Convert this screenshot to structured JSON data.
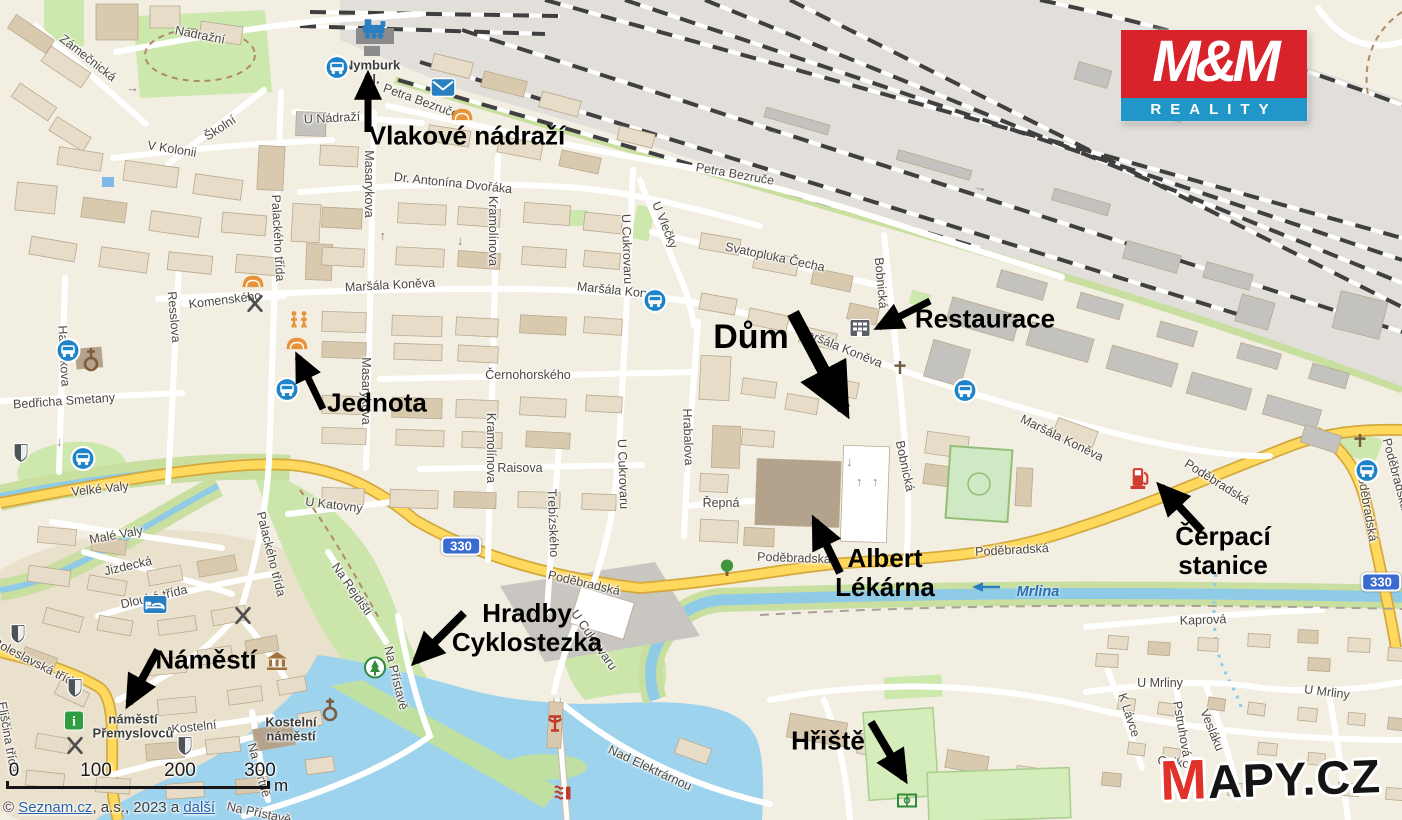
{
  "colors": {
    "road_yellow": "#ffd95e",
    "water_blue": "#9ed3ee",
    "brand_red": "#d8232a",
    "brand_blue": "#2196c9",
    "annotation": "#000000"
  },
  "branding": {
    "mm_logo": {
      "top": "M&M",
      "bottom": "REALITY"
    },
    "mapy_logo": {
      "m": "M",
      "rest": "APY.CZ"
    }
  },
  "attribution": {
    "p1": "© ",
    "link1": "Seznam.cz",
    "p2": ", a.s., 2023 a ",
    "link2": "další"
  },
  "scale_bar": {
    "ticks": [
      "0",
      "100",
      "200",
      "300"
    ],
    "unit": "m"
  },
  "route_badges": [
    {
      "text": "330",
      "x": 461,
      "y": 546
    },
    {
      "text": "330",
      "x": 1381,
      "y": 582
    }
  ],
  "annotations": [
    {
      "id": "vlakove-nadrazi",
      "lines": [
        "Vlakové nádraží"
      ],
      "x": 467,
      "y": 136,
      "size": 26,
      "arrow": {
        "x1": 368,
        "y1": 132,
        "x2": 368,
        "y2": 76,
        "w": 7
      }
    },
    {
      "id": "jednota",
      "lines": [
        "Jednota"
      ],
      "x": 377,
      "y": 403,
      "size": 26,
      "arrow": {
        "x1": 323,
        "y1": 409,
        "x2": 298,
        "y2": 357,
        "w": 7
      }
    },
    {
      "id": "dum",
      "lines": [
        "Dům"
      ],
      "x": 751,
      "y": 337,
      "size": 34,
      "arrow": {
        "x1": 793,
        "y1": 313,
        "x2": 844,
        "y2": 409,
        "w": 13
      }
    },
    {
      "id": "restaurace",
      "lines": [
        "Restaurace"
      ],
      "x": 985,
      "y": 319,
      "size": 26,
      "arrow": {
        "x1": 930,
        "y1": 301,
        "x2": 879,
        "y2": 327,
        "w": 7
      }
    },
    {
      "id": "albert-lekarna",
      "lines": [
        "Albert",
        "Lékárna"
      ],
      "x": 885,
      "y": 573,
      "size": 26,
      "arrow": {
        "x1": 840,
        "y1": 573,
        "x2": 815,
        "y2": 521,
        "w": 8
      }
    },
    {
      "id": "cerpaci-stanice",
      "lines": [
        "Čerpací",
        "stanice"
      ],
      "x": 1223,
      "y": 551,
      "size": 26,
      "arrow": {
        "x1": 1202,
        "y1": 531,
        "x2": 1161,
        "y2": 487,
        "w": 8
      }
    },
    {
      "id": "hradby-cyklostezka",
      "lines": [
        "Hradby",
        "Cyklostezka"
      ],
      "x": 527,
      "y": 628,
      "size": 26,
      "arrow": {
        "x1": 464,
        "y1": 613,
        "x2": 416,
        "y2": 661,
        "w": 8
      }
    },
    {
      "id": "namesti",
      "lines": [
        "Náměstí"
      ],
      "x": 206,
      "y": 660,
      "size": 26,
      "arrow": {
        "x1": 158,
        "y1": 650,
        "x2": 129,
        "y2": 703,
        "w": 8
      }
    },
    {
      "id": "hriste",
      "lines": [
        "Hřiště"
      ],
      "x": 828,
      "y": 741,
      "size": 26,
      "arrow": {
        "x1": 871,
        "y1": 722,
        "x2": 904,
        "y2": 778,
        "w": 8
      }
    }
  ],
  "area_labels": [
    {
      "lines": [
        "Nymburk",
        "hl."
      ],
      "x": 372,
      "y": 73
    },
    {
      "lines": [
        "náměstí",
        "Přemyslovců"
      ],
      "x": 133,
      "y": 727
    },
    {
      "lines": [
        "Kostelní",
        "náměstí"
      ],
      "x": 291,
      "y": 730
    }
  ],
  "water_labels": [
    {
      "text": "Mrlina",
      "x": 1038,
      "y": 592
    }
  ],
  "street_labels": [
    {
      "text": "Nádražní",
      "x": 200,
      "y": 35,
      "rot": 11
    },
    {
      "text": "Zámečnická",
      "x": 88,
      "y": 58,
      "rot": 38
    },
    {
      "text": "Školní",
      "x": 220,
      "y": 128,
      "rot": -33
    },
    {
      "text": "V Kolonii",
      "x": 172,
      "y": 149,
      "rot": 9
    },
    {
      "text": "U Nádraží",
      "x": 332,
      "y": 118,
      "rot": -3
    },
    {
      "text": "Petra Bezruče",
      "x": 421,
      "y": 101,
      "rot": 20
    },
    {
      "text": "Petra Bezruče",
      "x": 735,
      "y": 174,
      "rot": 10
    },
    {
      "text": "Dr. Antonína Dvořáka",
      "x": 453,
      "y": 183,
      "rot": 6
    },
    {
      "text": "Masarykova",
      "x": 369,
      "y": 184,
      "rot": 90
    },
    {
      "text": "Masarykova",
      "x": 366,
      "y": 391,
      "rot": 90
    },
    {
      "text": "Kramolínova",
      "x": 493,
      "y": 231,
      "rot": 90
    },
    {
      "text": "Kramolínova",
      "x": 491,
      "y": 448,
      "rot": 90
    },
    {
      "text": "U Cukrovaru",
      "x": 627,
      "y": 249,
      "rot": 88
    },
    {
      "text": "U Cukrovaru",
      "x": 623,
      "y": 474,
      "rot": 88
    },
    {
      "text": "U Cukrovaru",
      "x": 594,
      "y": 640,
      "rot": 55
    },
    {
      "text": "U Vlečky",
      "x": 665,
      "y": 225,
      "rot": 68
    },
    {
      "text": "Maršála Koněva",
      "x": 390,
      "y": 285,
      "rot": -3
    },
    {
      "text": "Maršála Koněva",
      "x": 622,
      "y": 291,
      "rot": 6
    },
    {
      "text": "Maršála Koněva",
      "x": 840,
      "y": 347,
      "rot": 22
    },
    {
      "text": "Maršála Koněva",
      "x": 1062,
      "y": 438,
      "rot": 26
    },
    {
      "text": "Svatopluka Čecha",
      "x": 775,
      "y": 257,
      "rot": 12
    },
    {
      "text": "Bobnická",
      "x": 881,
      "y": 283,
      "rot": 85
    },
    {
      "text": "Bobnická",
      "x": 905,
      "y": 466,
      "rot": 78
    },
    {
      "text": "Černohorského",
      "x": 528,
      "y": 375,
      "rot": 0
    },
    {
      "text": "Raisova",
      "x": 520,
      "y": 468,
      "rot": 0
    },
    {
      "text": "Trebízského",
      "x": 553,
      "y": 523,
      "rot": 88
    },
    {
      "text": "Hrabalova",
      "x": 688,
      "y": 437,
      "rot": 88
    },
    {
      "text": "Řepná",
      "x": 721,
      "y": 503,
      "rot": 0
    },
    {
      "text": "Poděbradská",
      "x": 584,
      "y": 583,
      "rot": 13
    },
    {
      "text": "Poděbradská",
      "x": 794,
      "y": 558,
      "rot": 2
    },
    {
      "text": "Poděbradská",
      "x": 1012,
      "y": 550,
      "rot": -3
    },
    {
      "text": "Poděbradská",
      "x": 1217,
      "y": 482,
      "rot": 32
    },
    {
      "text": "Poděbradská",
      "x": 1367,
      "y": 505,
      "rot": 80
    },
    {
      "text": "Poděbradská",
      "x": 1396,
      "y": 474,
      "rot": 75
    },
    {
      "text": "Velké Valy",
      "x": 100,
      "y": 489,
      "rot": -6
    },
    {
      "text": "Malé Valy",
      "x": 116,
      "y": 535,
      "rot": -10
    },
    {
      "text": "Jizdecká",
      "x": 128,
      "y": 566,
      "rot": -13
    },
    {
      "text": "Dlouhá třída",
      "x": 154,
      "y": 597,
      "rot": -13
    },
    {
      "text": "Palackého třída",
      "x": 278,
      "y": 238,
      "rot": 87
    },
    {
      "text": "Palackého třída",
      "x": 271,
      "y": 554,
      "rot": 76
    },
    {
      "text": "Resslova",
      "x": 174,
      "y": 317,
      "rot": 85
    },
    {
      "text": "Komenského",
      "x": 225,
      "y": 300,
      "rot": -7
    },
    {
      "text": "Havlíčkova",
      "x": 64,
      "y": 356,
      "rot": 87
    },
    {
      "text": "Bedřicha Smetany",
      "x": 64,
      "y": 401,
      "rot": -4
    },
    {
      "text": "Eliščina třída",
      "x": 8,
      "y": 737,
      "rot": 80
    },
    {
      "text": "Boleslavská třída",
      "x": 36,
      "y": 663,
      "rot": 27
    },
    {
      "text": "Kostelní",
      "x": 194,
      "y": 727,
      "rot": -6
    },
    {
      "text": "Na Fortně",
      "x": 259,
      "y": 770,
      "rot": 74
    },
    {
      "text": "Na Rejdišti",
      "x": 352,
      "y": 589,
      "rot": 55
    },
    {
      "text": "Na Přístavě",
      "x": 396,
      "y": 678,
      "rot": 76
    },
    {
      "text": "Na Přístavě",
      "x": 259,
      "y": 813,
      "rot": 12
    },
    {
      "text": "U Katovny",
      "x": 334,
      "y": 505,
      "rot": 7
    },
    {
      "text": "Kaprová",
      "x": 1203,
      "y": 620,
      "rot": -2
    },
    {
      "text": "U Mrliny",
      "x": 1160,
      "y": 683,
      "rot": 0
    },
    {
      "text": "U Mrliny",
      "x": 1327,
      "y": 692,
      "rot": 7
    },
    {
      "text": "K Lávce",
      "x": 1129,
      "y": 715,
      "rot": 72
    },
    {
      "text": "Pstruhová",
      "x": 1182,
      "y": 729,
      "rot": 80
    },
    {
      "text": "Vesláku",
      "x": 1212,
      "y": 730,
      "rot": 68
    },
    {
      "text": "Osiková",
      "x": 1180,
      "y": 763,
      "rot": 7
    },
    {
      "text": "Nad Elektrárnou",
      "x": 650,
      "y": 768,
      "rot": 25
    }
  ],
  "pois": [
    {
      "icon": "train",
      "x": 375,
      "y": 32
    },
    {
      "icon": "bus",
      "x": 337,
      "y": 70
    },
    {
      "icon": "post",
      "x": 443,
      "y": 90
    },
    {
      "icon": "shop",
      "x": 462,
      "y": 116
    },
    {
      "icon": "shop",
      "x": 297,
      "y": 345
    },
    {
      "icon": "shop",
      "x": 253,
      "y": 283
    },
    {
      "icon": "playground",
      "x": 299,
      "y": 322
    },
    {
      "icon": "bus",
      "x": 287,
      "y": 392
    },
    {
      "icon": "bus",
      "x": 68,
      "y": 353
    },
    {
      "icon": "bus",
      "x": 83,
      "y": 461
    },
    {
      "icon": "bus",
      "x": 655,
      "y": 303
    },
    {
      "icon": "bus",
      "x": 965,
      "y": 393
    },
    {
      "icon": "bus",
      "x": 1367,
      "y": 473
    },
    {
      "icon": "restaurant",
      "x": 255,
      "y": 306
    },
    {
      "icon": "restaurant",
      "x": 243,
      "y": 618
    },
    {
      "icon": "restaurant",
      "x": 75,
      "y": 748
    },
    {
      "icon": "building",
      "x": 860,
      "y": 330
    },
    {
      "icon": "church",
      "x": 91,
      "y": 362
    },
    {
      "icon": "church",
      "x": 330,
      "y": 712
    },
    {
      "icon": "cross",
      "x": 900,
      "y": 370
    },
    {
      "icon": "cross",
      "x": 1360,
      "y": 443
    },
    {
      "icon": "hotel",
      "x": 155,
      "y": 607
    },
    {
      "icon": "info",
      "x": 74,
      "y": 723
    },
    {
      "icon": "museum",
      "x": 277,
      "y": 663
    },
    {
      "icon": "monument",
      "x": 21,
      "y": 455
    },
    {
      "icon": "monument",
      "x": 18,
      "y": 636
    },
    {
      "icon": "monument",
      "x": 75,
      "y": 690
    },
    {
      "icon": "monument",
      "x": 185,
      "y": 748
    },
    {
      "icon": "tree",
      "x": 727,
      "y": 570
    },
    {
      "icon": "park",
      "x": 375,
      "y": 670
    },
    {
      "icon": "fuel",
      "x": 1140,
      "y": 480
    },
    {
      "icon": "sports",
      "x": 907,
      "y": 803
    },
    {
      "icon": "harbor",
      "x": 555,
      "y": 727
    },
    {
      "icon": "weir",
      "x": 563,
      "y": 795
    },
    {
      "icon": "flow-arrow",
      "x": 986,
      "y": 589
    }
  ]
}
